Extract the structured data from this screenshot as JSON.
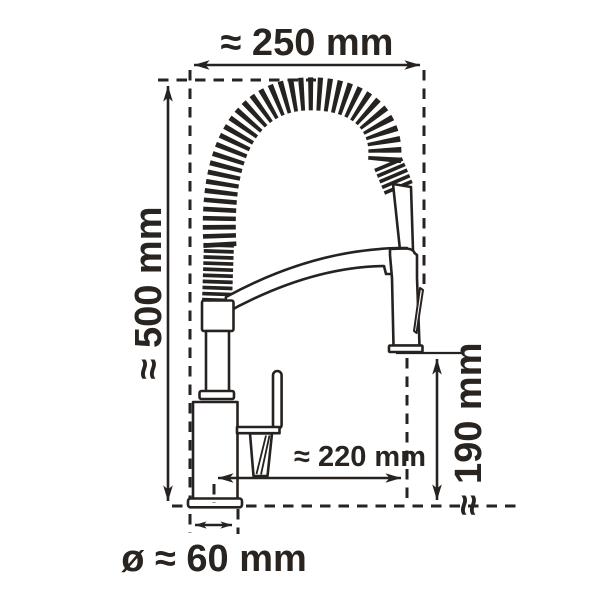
{
  "diagram": {
    "stroke_color": "#262220",
    "text_color": "#29241f",
    "background": "#ffffff",
    "labels": {
      "width_overall": "≈ 250 mm",
      "height_overall": "≈ 500 mm",
      "spout_reach": "≈ 220 mm",
      "outlet_height": "≈ 190 mm",
      "base_diameter": "ø ≈ 60 mm"
    }
  }
}
